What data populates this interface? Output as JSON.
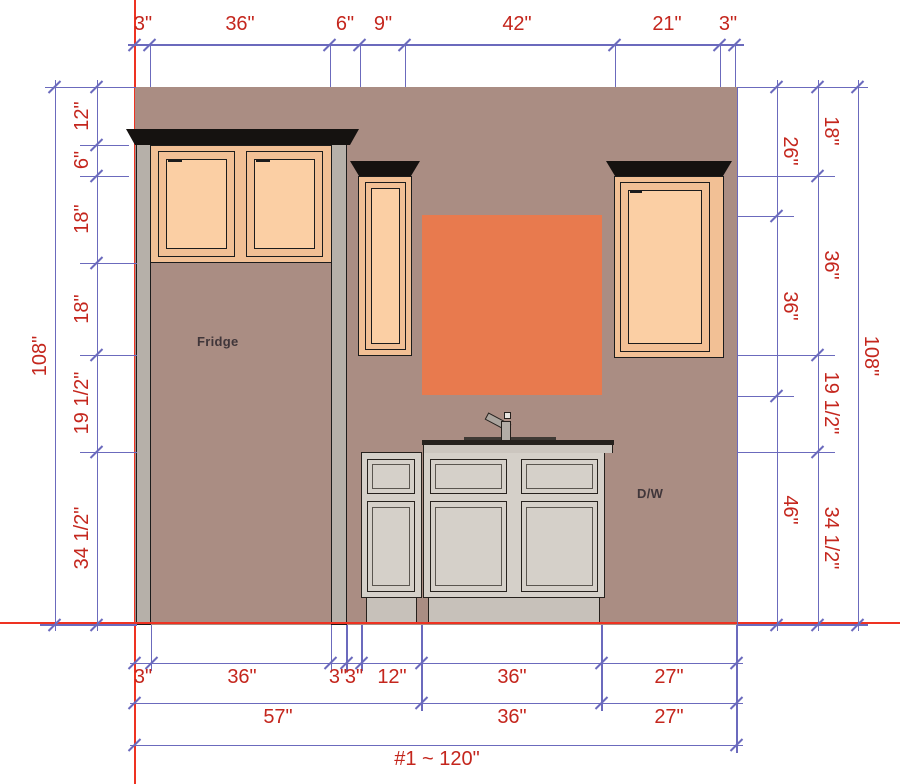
{
  "drawing": {
    "type": "kitchen-elevation",
    "wall_width_label": "#1 ~ 120\"",
    "wall_height_label": "108\""
  },
  "dims": {
    "top": [
      "3\"",
      "36\"",
      "6\"",
      "9\"",
      "42\"",
      "21\"",
      "3\""
    ],
    "left": [
      "12\"",
      "6\"",
      "18\"",
      "18\"",
      "19 1/2\"",
      "34 1/2\""
    ],
    "left_total": "108\"",
    "right_window_chain": [
      "26\"",
      "36\"",
      "46\""
    ],
    "right_cabinet_chain": [
      "18\"",
      "36\"",
      "19 1/2\"",
      "34 1/2\""
    ],
    "right_total": "108\"",
    "bottom_row1": [
      "3\"",
      "36\"",
      "3\"",
      "3\"",
      "12\"",
      "36\"",
      "27\""
    ],
    "bottom_row2": [
      "57\"",
      "36\"",
      "27\""
    ],
    "bottom_total": "#1 ~ 120\""
  },
  "labels": {
    "fridge": "Fridge",
    "dishwasher": "D/W"
  },
  "colors": {
    "wall": "#aa8d83",
    "window": "#e87a4e",
    "cabinet_frame": "#f2c095",
    "cabinet_door_panel": "#fbcfa4",
    "base_cabinet": "#d5d0c9",
    "toe_kick": "#c7c1ba",
    "crown_molding": "#151210",
    "dimension_line": "#6b6abd",
    "dimension_text": "#c4261d",
    "construction_line": "#ee3322"
  }
}
